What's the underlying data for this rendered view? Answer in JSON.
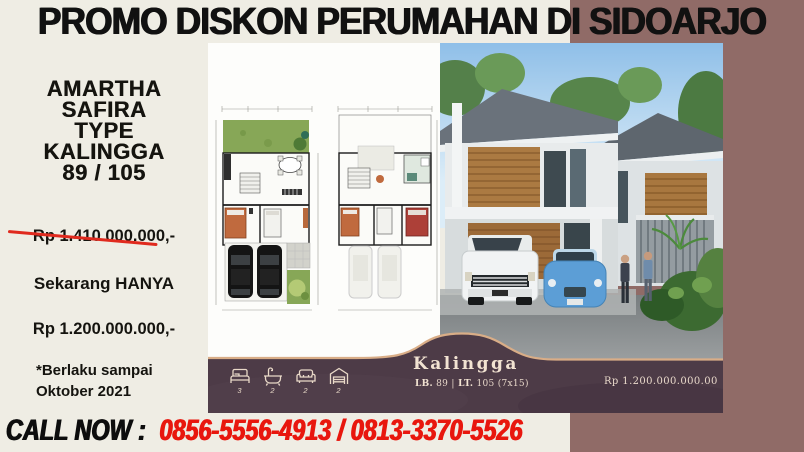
{
  "colors": {
    "cream_bg": "#efede4",
    "mauve_accent": "#906b67",
    "banner_plum": "#4d3b47",
    "banner_edge_tan": "#d9ad87",
    "headline_black": "#111111",
    "phone_red": "#e8170e",
    "strike_red": "#e02a1e",
    "banner_text_cream": "#f2e3d2"
  },
  "header": {
    "title": "PROMO DISKON PERUMAHAN DI SIDOARJO"
  },
  "left_panel": {
    "heading_lines": [
      "AMARTHA",
      "SAFIRA",
      "TYPE",
      "KALINGGA",
      "89 / 105"
    ],
    "old_price": "Rp 1.410.000.000,-",
    "now_label": "Sekarang HANYA",
    "new_price": "Rp 1.200.000.000,-",
    "validity_line1": "*Berlaku sampai",
    "validity_line2": "Oktober 2021"
  },
  "listing_banner": {
    "name": "Kalingga",
    "spec_lb_label": "LB.",
    "spec_lb_value": " 89 ",
    "spec_separator": "|",
    "spec_lt_label": " LT.",
    "spec_lt_value": " 105 (7x15)",
    "price": "Rp 1.200.000.000.00",
    "features": [
      {
        "icon": "bed-icon",
        "count": "3"
      },
      {
        "icon": "bathtub-icon",
        "count": "2"
      },
      {
        "icon": "sofa-icon",
        "count": "2"
      },
      {
        "icon": "garage-icon",
        "count": "2"
      }
    ]
  },
  "call_banner": {
    "label": "CALL NOW :",
    "phones": "0856-5556-4913 / 0813-3370-5526"
  }
}
